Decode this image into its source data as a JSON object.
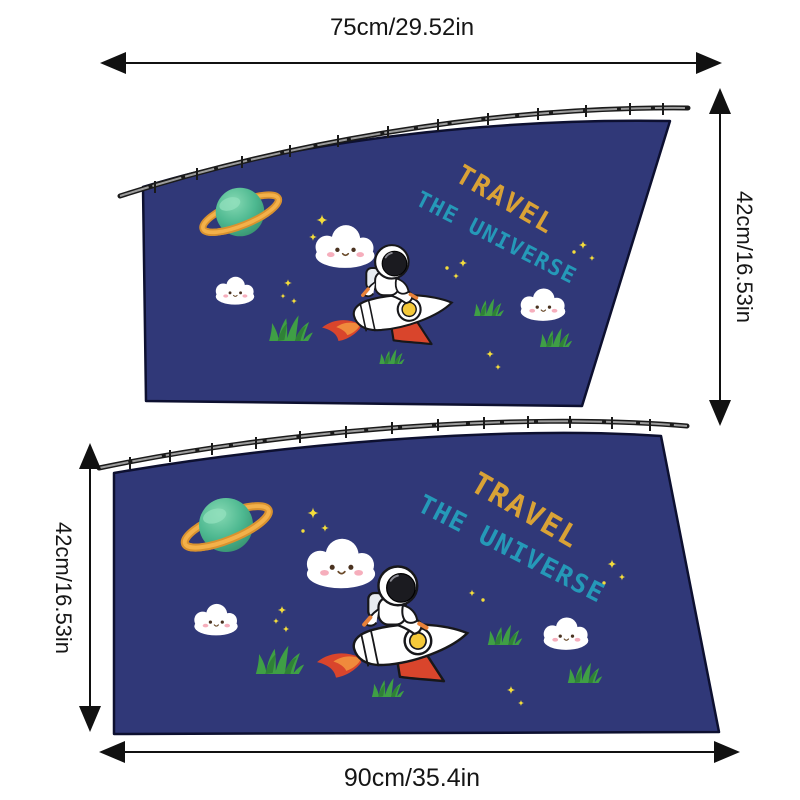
{
  "dimensions": {
    "top": {
      "label": "75cm/29.52in"
    },
    "right": {
      "label": "42cm/16.53in"
    },
    "left": {
      "label": "42cm/16.53in"
    },
    "bottom": {
      "label": "90cm/35.4in"
    }
  },
  "artwork": {
    "print_line1": "TRAVEL",
    "print_line2": "THE UNIVERSE"
  },
  "colors": {
    "fabric": "#303878",
    "fabric_outline": "#0d1030",
    "travel_text": "#d9a236",
    "universe_text": "#2599b8",
    "dimension_text": "#151515",
    "rocket_red": "#d9452c",
    "planet_green": "#4db890",
    "ring_orange": "#f3b14a",
    "grass_green": "#3f9f45",
    "star_yellow": "#f4dd3b",
    "cloud_white": "#ffffff",
    "rail_dark": "#1a1a1a"
  }
}
